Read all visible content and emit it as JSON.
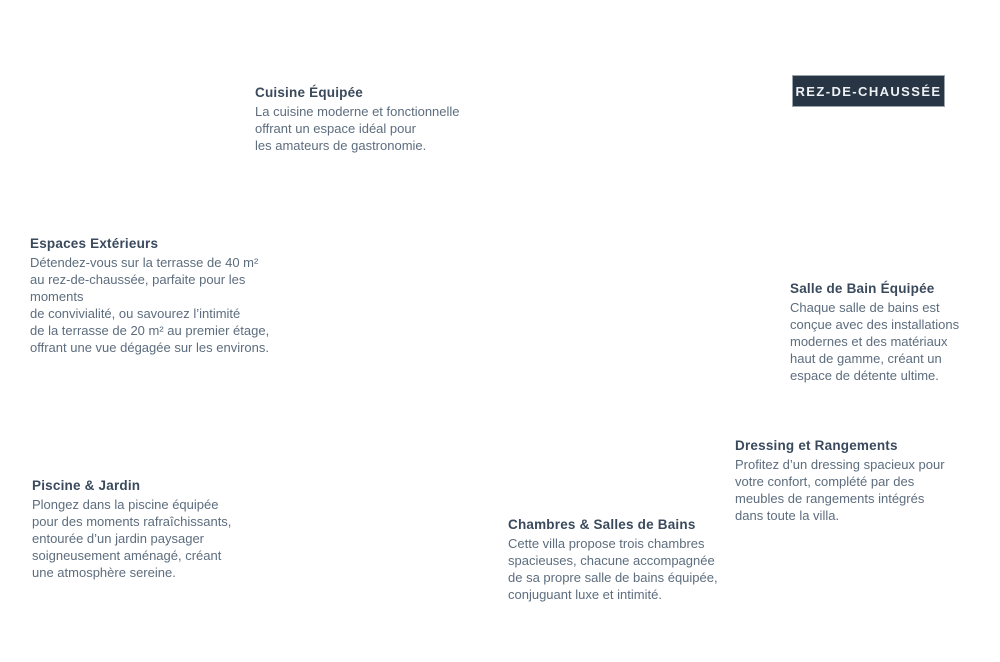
{
  "badge": {
    "label": "REZ-DE-CHAUSSÉE"
  },
  "colors": {
    "page_bg": "#ffffff",
    "badge_bg": "#273544",
    "badge_border": "#9ba4ad",
    "badge_text": "#eef1f4",
    "title": "#3a4a5c",
    "body": "#5d6d7e",
    "leader": "#44556c",
    "grass": "#8aa062",
    "grass_shade": "#7f9657",
    "deck": "#9c6b4a",
    "pool_water": "#b8bab6",
    "pool_rim": "#2c332e",
    "gravel": "#c6ad8e",
    "house_wall": "#f1eee7",
    "floor_living": "#c4a785",
    "floor_kitchen": "#ccb294",
    "floor_hall": "#d8c3a6",
    "floor_bedroom": "#c0a381",
    "floor_bedroom2": "#c6a988",
    "floor_bath": "#d0c1ac",
    "stairs": "#e6e0d4",
    "stair_tread": "#cfc8ba",
    "wall_dark": "#484e42",
    "wall_west": "#4d5347",
    "wall_light": "#d8d5cb",
    "hedge": "#3f5539",
    "tree_dark": "#41603a",
    "tree_mid": "#54713f",
    "tree_light": "#69874e",
    "car_body": "#a5cb3e",
    "car_roof": "#3b4046",
    "lounger": "#dbcba7",
    "planter": "#7d5438",
    "step": "#cdb794",
    "step_alt": "#c0aa85",
    "furniture_dark": "#5c6066",
    "courtyard": "#dbcfba",
    "fixture_white": "#f4f2ec"
  },
  "annotations": [
    {
      "id": "cuisine",
      "title": "Cuisine Équipée",
      "body": "La cuisine moderne et fonctionnelle\noffrant un espace idéal pour\nles amateurs de gastronomie."
    },
    {
      "id": "espaces",
      "title": "Espaces Extérieurs",
      "body": "Détendez-vous sur la terrasse de 40 m²\nau rez-de-chaussée, parfaite pour les moments\nde convivialité, ou savourez l’intimité\nde la terrasse de 20 m² au premier étage,\noffrant une vue dégagée sur les environs."
    },
    {
      "id": "piscine",
      "title": "Piscine & Jardin",
      "body": "Plongez dans la piscine équipée\npour des moments rafraîchissants,\nentourée d’un jardin paysager\nsoigneusement aménagé, créant\nune atmosphère sereine."
    },
    {
      "id": "chambres",
      "title": "Chambres & Salles de Bains",
      "body": "Cette villa propose trois chambres\nspacieuses, chacune accompagnée\nde sa propre salle de bains équipée,\nconjuguant luxe et intimité."
    },
    {
      "id": "dressing",
      "title": "Dressing et Rangements",
      "body": "Profitez d’un dressing spacieux pour\nvotre confort, complété par des\nmeubles de rangements intégrés\ndans toute la villa."
    },
    {
      "id": "salle_de_bain",
      "title": "Salle de Bain Équipée",
      "body": "Chaque salle de bains est\nconçue avec des installations\nmodernes et des matériaux\nhaut de gamme, créant un\nespace de détente ultime."
    }
  ]
}
